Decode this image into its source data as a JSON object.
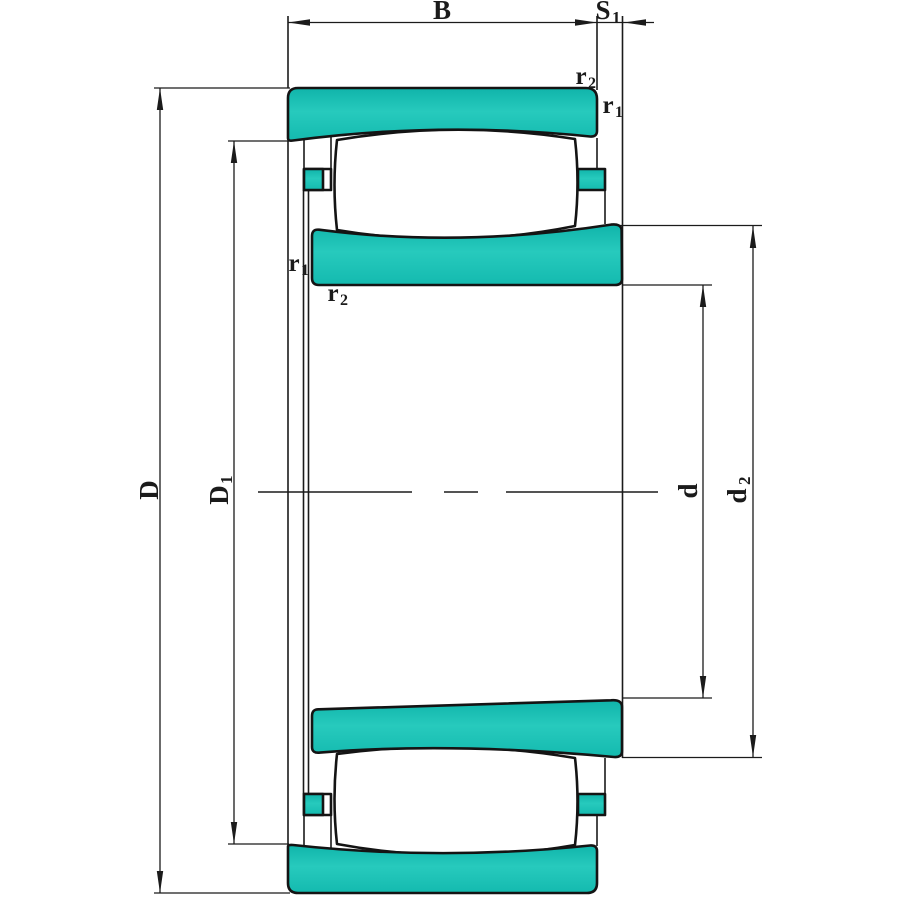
{
  "drawing": {
    "title": "spherical-roller-bearing-cross-section",
    "colors": {
      "ring_fill": "#1CBFB4",
      "ring_fill_dark": "#0FB3A9",
      "ring_fill_light": "#27CABD",
      "outline": "#1B1B1B",
      "background": "#FFFFFF"
    },
    "labels": {
      "width": {
        "main": "B",
        "sub": ""
      },
      "axial_displacement": {
        "main": "S",
        "sub": "1"
      },
      "outer_diameter": {
        "main": "D",
        "sub": ""
      },
      "outer_recess_diameter": {
        "main": "D",
        "sub": "1"
      },
      "bore_diameter": {
        "main": "d",
        "sub": ""
      },
      "inner_shoulder_diameter": {
        "main": "d",
        "sub": "2"
      },
      "outer_ring_radius_od": {
        "main": "r",
        "sub": "2"
      },
      "outer_ring_radius_face": {
        "main": "r",
        "sub": "1"
      },
      "inner_ring_radius_face": {
        "main": "r",
        "sub": "1"
      },
      "inner_ring_radius_bore": {
        "main": "r",
        "sub": "2"
      }
    }
  }
}
